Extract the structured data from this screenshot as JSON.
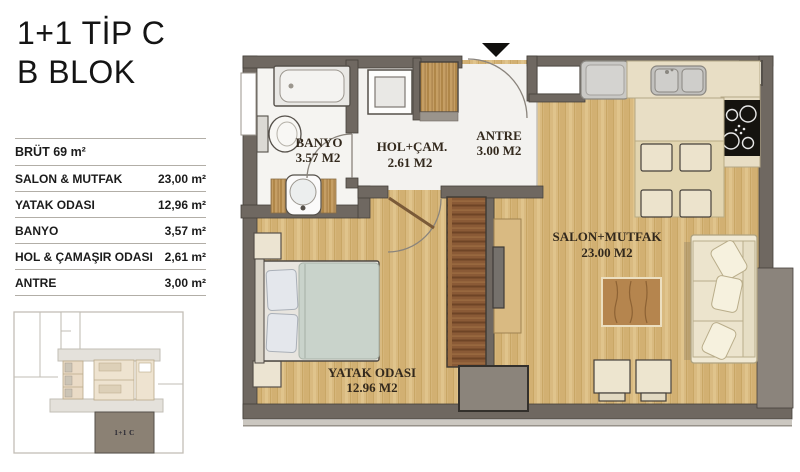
{
  "title": {
    "line1": "1+1 TİP C",
    "line2": "B BLOK"
  },
  "area_table": {
    "header": "BRÜT 69 m²",
    "rows": [
      {
        "label": "SALON & MUTFAK",
        "value": "23,00 m²"
      },
      {
        "label": "YATAK ODASI",
        "value": "12,96 m²"
      },
      {
        "label": "BANYO",
        "value": "3,57 m²"
      },
      {
        "label": "HOL & ÇAMAŞIR ODASI",
        "value": "2,61 m²"
      },
      {
        "label": "ANTRE",
        "value": "3,00 m²"
      }
    ]
  },
  "floor_plan": {
    "rooms": {
      "banyo": {
        "name": "BANYO",
        "area": "3.57 M2"
      },
      "hol": {
        "name": "HOL+ÇAM.",
        "area": "2.61 M2"
      },
      "antre": {
        "name": "ANTRE",
        "area": "3.00 M2"
      },
      "salon": {
        "name": "SALON+MUTFAK",
        "area": "23.00 M2"
      },
      "yatak": {
        "name": "YATAK ODASI",
        "area": "12.96 M2"
      }
    }
  },
  "key_plan": {
    "unit_label": "1+1 C"
  },
  "colors": {
    "wall": "#6f6861",
    "wood_floor": "#d7b67a",
    "tile_floor": "#f3f2ef",
    "wardrobe": "#8a5a36",
    "counter": "#e8dec5",
    "sofa": "#f0e9d4",
    "highlight_unit": "#8b8174",
    "label_text": "#33291d"
  }
}
